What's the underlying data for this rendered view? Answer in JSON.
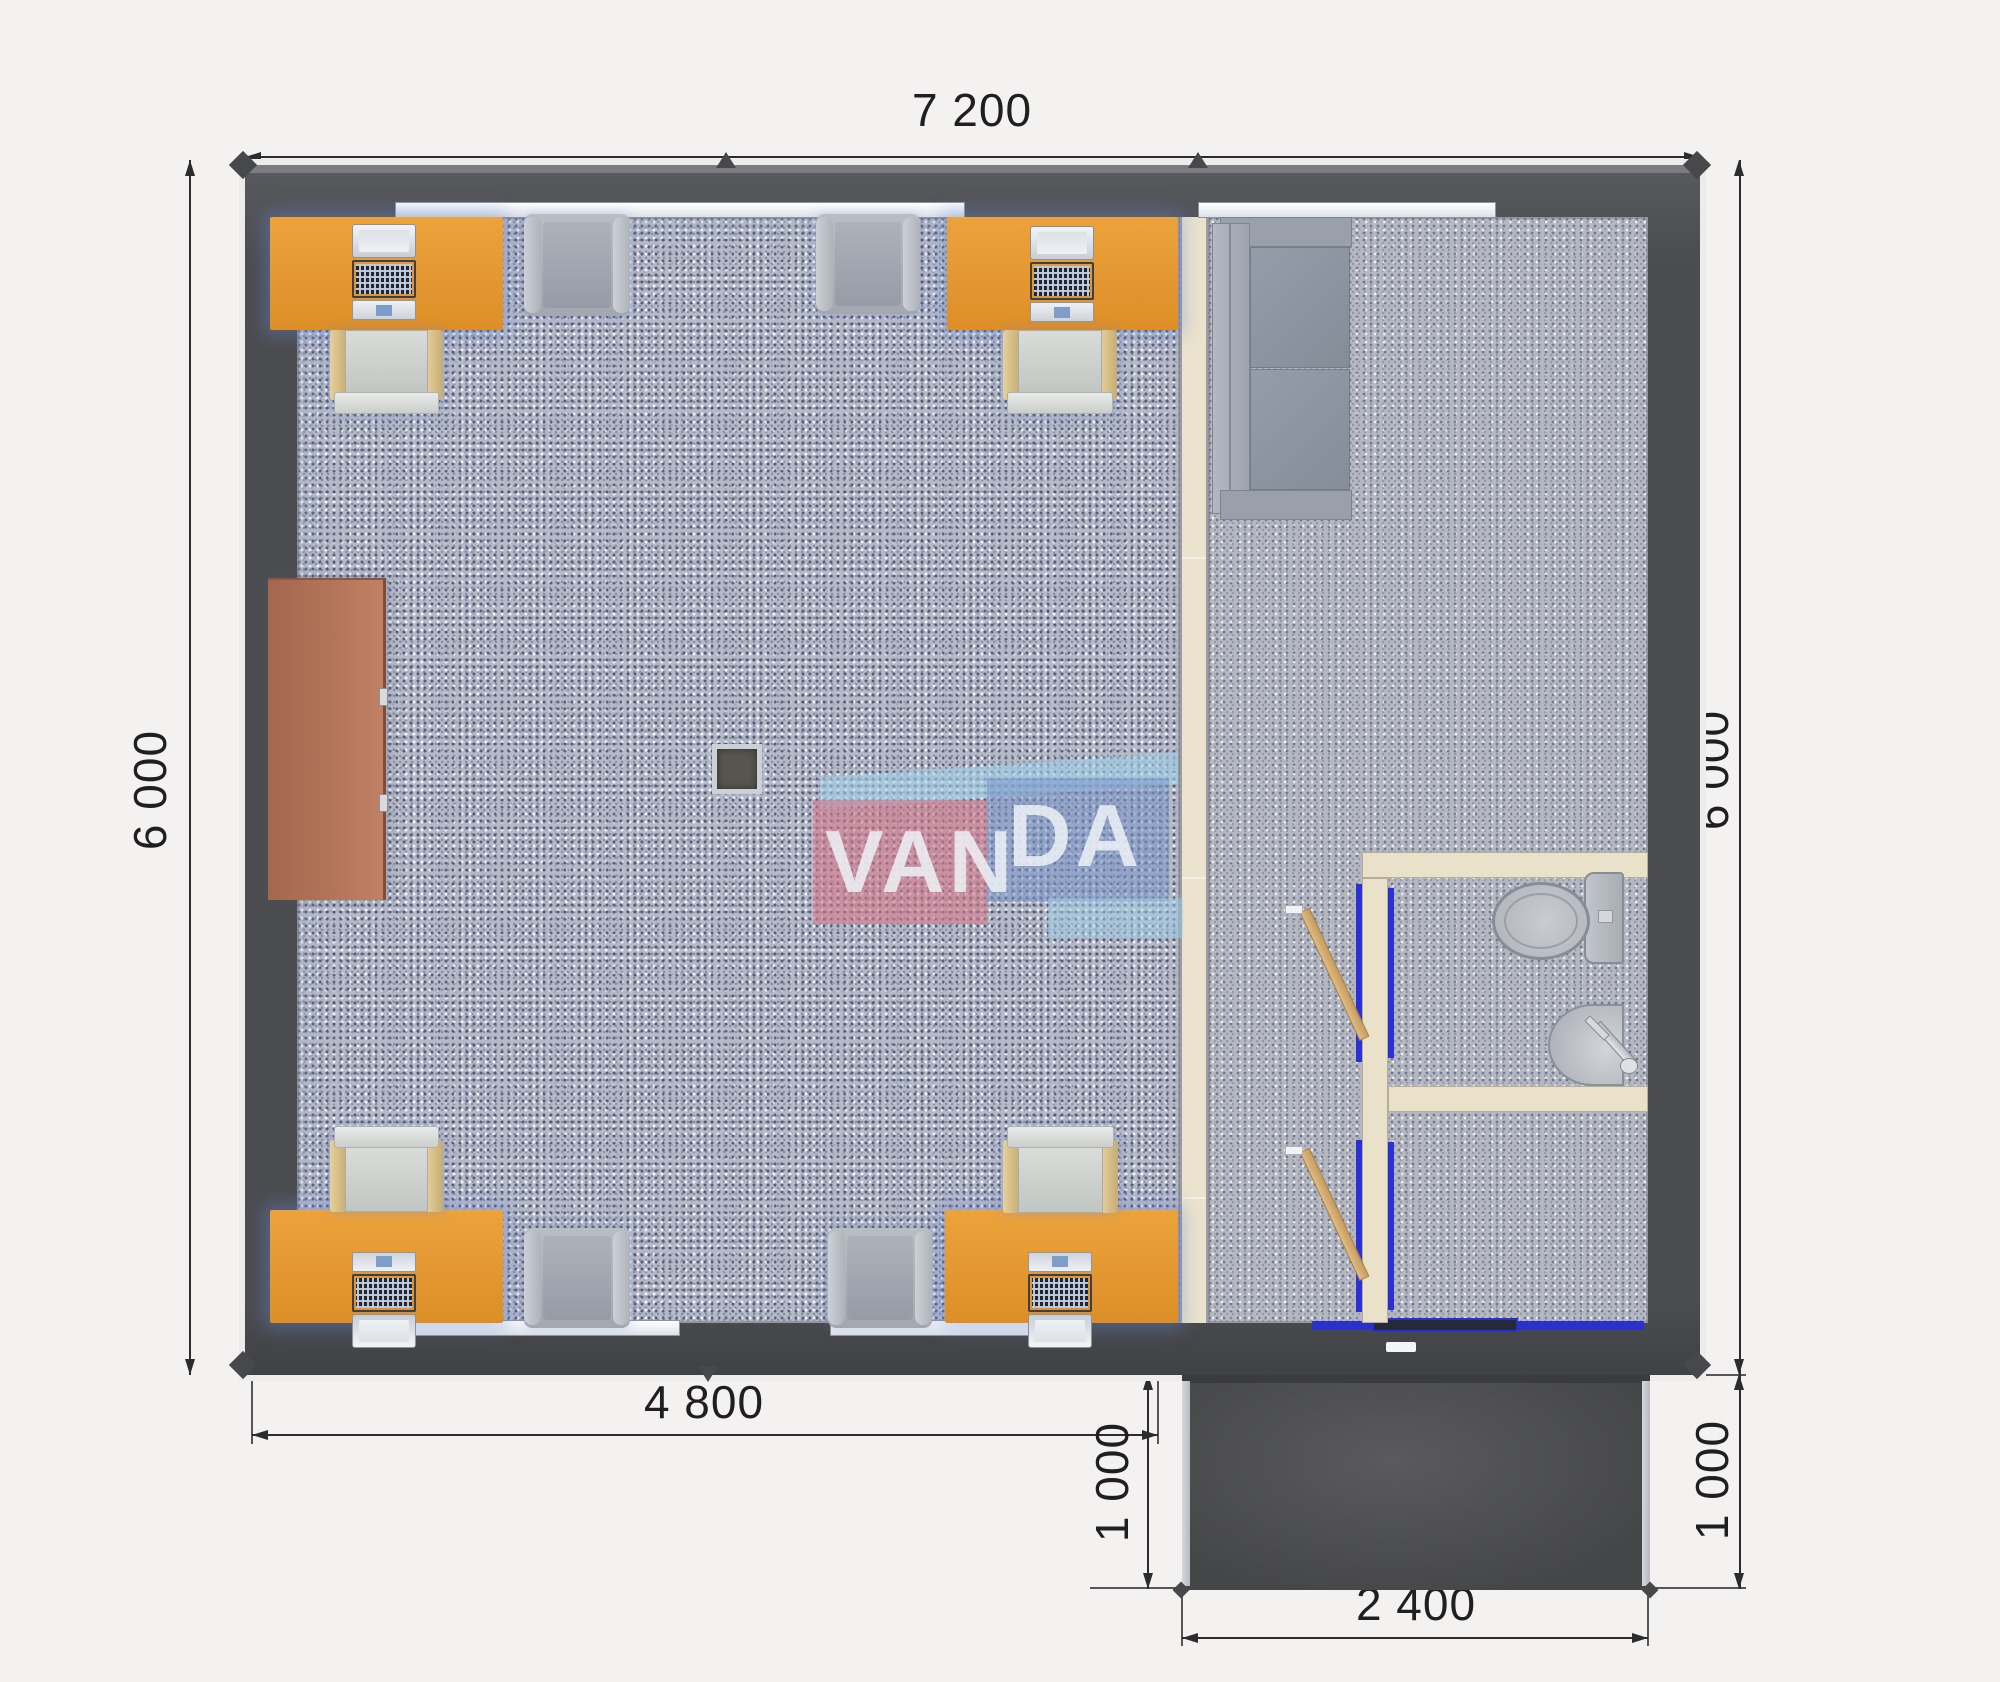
{
  "document": {
    "kind": "floor-plan",
    "units": "mm"
  },
  "watermark": {
    "van": "VAN",
    "da": "DA"
  },
  "dims": {
    "top_width": "7 200",
    "left_height": "6 000",
    "right_height": "6 000",
    "bottom_office_width": "4 800",
    "porch_depth_left": "1 000",
    "porch_depth_right": "1 000",
    "porch_width": "2 400"
  },
  "objects": {
    "desks": 4,
    "desktop_computers": 4,
    "office_chairs": 4,
    "guest_armchairs": 4,
    "sofas": 1,
    "cabinets": 1,
    "support_columns": 1,
    "toilets": 1,
    "washbasins": 1,
    "interior_doors": 2,
    "entrance_doors": 1,
    "windows": 4,
    "porches": 1
  },
  "colors": {
    "background": "#f3f2f0",
    "wall": "#4f5054",
    "floor_left_room": "#b6bac7",
    "floor_right_room": "#b5b8c1",
    "partition": "#ebe3cd",
    "desk": "#e3952f",
    "cabinet": "#b5765b",
    "door_frame": "#2b30c9",
    "door_leaf": "#d8b078",
    "porch": "#4b4c4e",
    "fixture_gray": "#b6bac0",
    "logo_pink": "#d78894",
    "logo_blue": "#7894c8",
    "logo_sky": "#a0d0e8",
    "dimension_text": "#2c2c2e"
  }
}
